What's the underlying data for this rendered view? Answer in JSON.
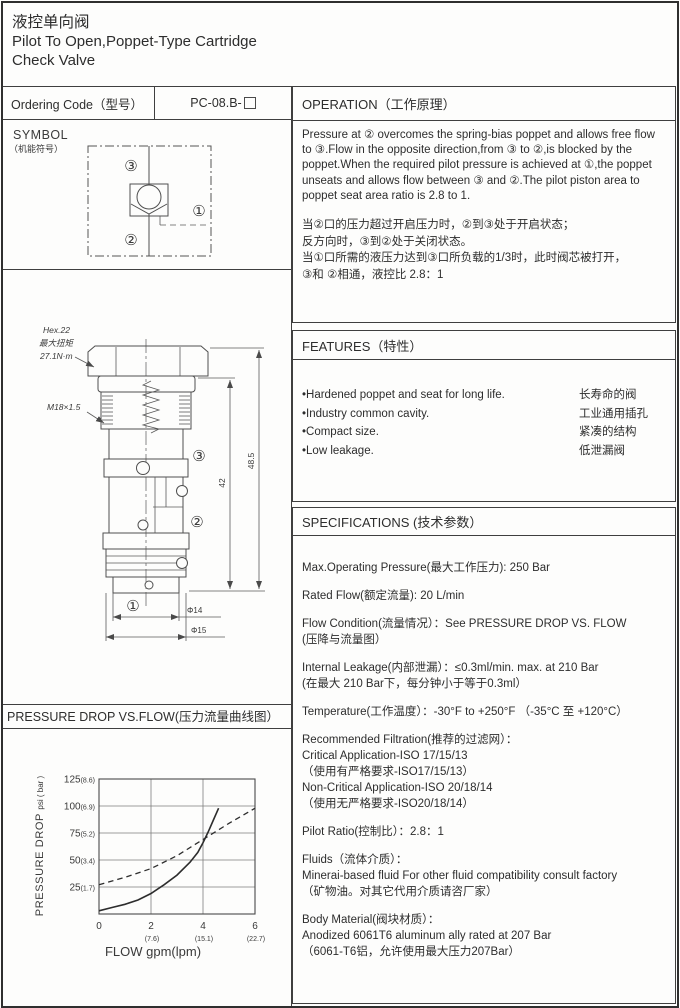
{
  "header": {
    "title_cn": "液控单向阀",
    "title_en_1": "Pilot To Open,Poppet-Type Cartridge",
    "title_en_2": "Check Valve"
  },
  "ordering": {
    "label": "Ordering Code（型号）",
    "code": "PC-08.B-"
  },
  "symbol": {
    "title": "SYMBOL",
    "subtitle": "（机能符号）",
    "port_1": "①",
    "port_2": "②",
    "port_3": "③"
  },
  "drawing": {
    "hex_label": "Hex.22",
    "torque_cn": "最大扭矩",
    "torque_val": "27.1N·m",
    "thread_label": "M18×1.5",
    "dim_overall": "48.5",
    "dim_body": "42",
    "dim_dia14": "Φ14",
    "dim_dia15": "Φ15",
    "port_1": "①",
    "port_2": "②",
    "port_3": "③"
  },
  "operation": {
    "title": "OPERATION（工作原理）",
    "en": "Pressure at ② overcomes the spring-bias poppet and allows free flow to ③.Flow in the opposite direction,from ③ to ②,is blocked by the poppet.When the required pilot pressure is achieved at ①,the poppet unseats and allows flow between ③ and ②.The pilot piston area to poppet seat area ratio is 2.8 to 1.",
    "cn_lines": [
      "当②口的压力超过开启压力时，②到③处于开启状态；",
      "反方向时，③到②处于关闭状态。",
      "当①口所需的液压力达到③口所负载的1/3时，此时阀芯被打开，",
      "③和 ②相通，液控比 2.8：1"
    ]
  },
  "features": {
    "title": "FEATURES（特性）",
    "items": [
      {
        "en": "•Hardened poppet and seat for long life.",
        "cn": "长寿命的阀"
      },
      {
        "en": "•Industry common cavity.",
        "cn": "工业通用插孔"
      },
      {
        "en": "•Compact size.",
        "cn": "紧凑的结构"
      },
      {
        "en": "•Low leakage.",
        "cn": "低泄漏阀"
      }
    ]
  },
  "specifications": {
    "title": "SPECIFICATIONS (技术参数）",
    "items": [
      {
        "lines": [
          "Max.Operating Pressure(最大工作压力): 250 Bar"
        ]
      },
      {
        "lines": [
          "Rated Flow(额定流量): 20 L/min"
        ]
      },
      {
        "lines": [
          "Flow Condition(流量情况）：See PRESSURE DROP VS. FLOW",
          "(压降与流量图）"
        ]
      },
      {
        "lines": [
          "Internal Leakage(内部泄漏）：≤0.3ml/min. max. at 210 Bar",
          "(在最大 210 Bar下，每分钟小于等于0.3ml）"
        ]
      },
      {
        "lines": [
          "Temperature(工作温度）：-30°F to +250°F （-35°C 至 +120°C）"
        ]
      },
      {
        "lines": [
          "Recommended Filtration(推荐的过滤网）：",
          "Critical Application-ISO 17/15/13",
          "（使用有严格要求-ISO17/15/13）",
          "Non-Critical Application-ISO 20/18/14",
          "（使用无严格要求-ISO20/18/14）"
        ]
      },
      {
        "lines": [
          "Pilot Ratio(控制比）：2.8：1"
        ]
      },
      {
        "lines": [
          "Fluids（流体介质）：",
          "Minerai-based fluid For other  fluid compatibility consult  factory",
          "（矿物油。对其它代用介质请咨厂家）"
        ]
      },
      {
        "lines": [
          "Body Material(阀块材质）：",
          "Anodized 6061T6 aluminum ally rated at 207 Bar",
          "（6061-T6铝，允许使用最大压力207Bar）"
        ]
      }
    ]
  },
  "pressure_chart_header": "PRESSURE DROP VS.FLOW(压力流量曲线图）",
  "chart_data": {
    "type": "line",
    "title": "PRESSURE DROP VS.FLOW(压力流量曲线图）",
    "xlabel": "FLOW gpm(lpm)",
    "ylabel": "PRESSURE DROP psi ( bar )",
    "ylabel_main": "PRESSURE DROP",
    "ylabel_sub": "psi ( bar )",
    "xlim": [
      0,
      6
    ],
    "ylim": [
      0,
      125
    ],
    "grid": true,
    "legend_position": "none",
    "xticks": [
      {
        "v": 0,
        "label": "0",
        "sub": ""
      },
      {
        "v": 2,
        "label": "2",
        "sub": "(7.6)"
      },
      {
        "v": 4,
        "label": "4",
        "sub": "(15.1)"
      },
      {
        "v": 6,
        "label": "6",
        "sub": "(22.7)"
      }
    ],
    "yticks": [
      {
        "v": 25,
        "label": "25",
        "sub": "(1.7)"
      },
      {
        "v": 50,
        "label": "50",
        "sub": "(3.4)"
      },
      {
        "v": 75,
        "label": "75",
        "sub": "(5.2)"
      },
      {
        "v": 100,
        "label": "100",
        "sub": "(6.9)"
      },
      {
        "v": 125,
        "label": "125",
        "sub": "(8.6)"
      }
    ],
    "series": [
      {
        "name": "free flow 2 to 3",
        "style": "solid",
        "points": [
          [
            0,
            3
          ],
          [
            0.5,
            6
          ],
          [
            1,
            9
          ],
          [
            1.5,
            13
          ],
          [
            2,
            19
          ],
          [
            2.5,
            27
          ],
          [
            3,
            36
          ],
          [
            3.5,
            48
          ],
          [
            3.8,
            57
          ],
          [
            4,
            66
          ],
          [
            4.2,
            76
          ],
          [
            4.4,
            87
          ],
          [
            4.6,
            98
          ]
        ]
      },
      {
        "name": "pilot open 3 to 2",
        "style": "dashed",
        "points": [
          [
            0,
            27
          ],
          [
            1,
            34
          ],
          [
            2,
            42
          ],
          [
            3,
            54
          ],
          [
            4,
            69
          ],
          [
            5,
            84
          ],
          [
            6,
            98
          ]
        ]
      }
    ]
  }
}
